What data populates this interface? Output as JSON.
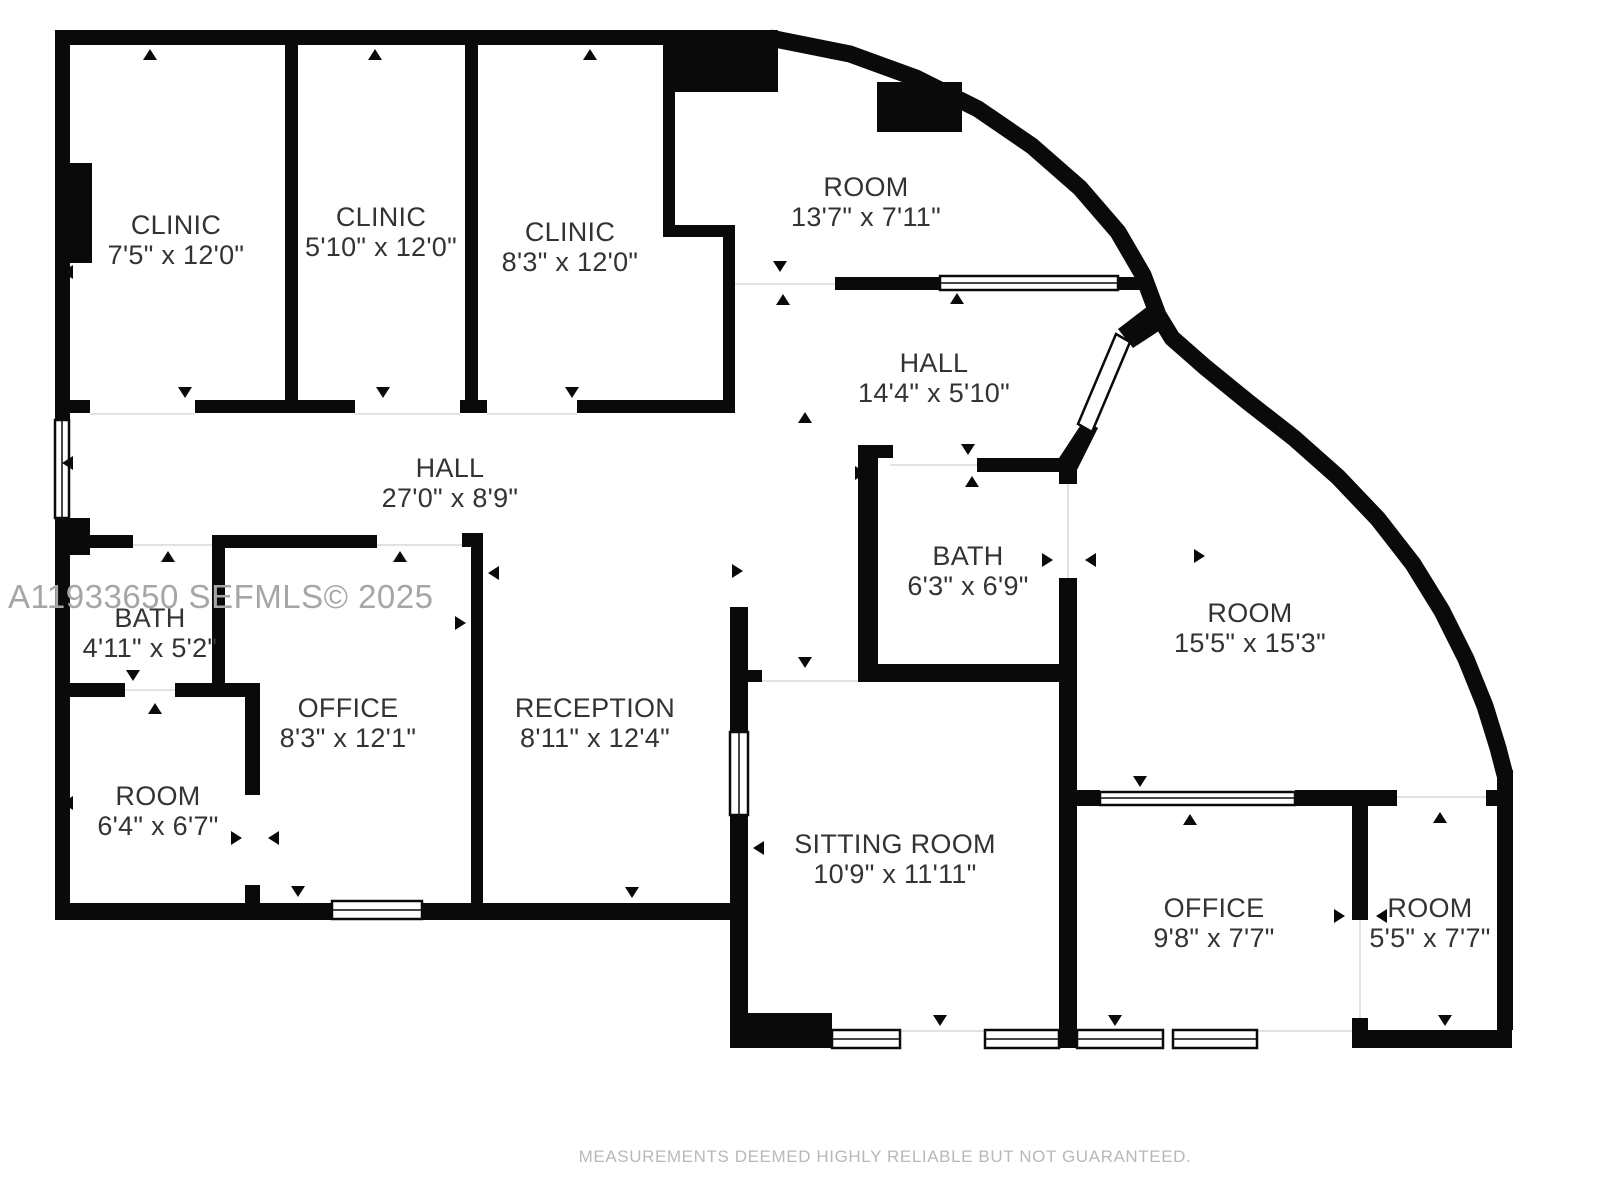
{
  "floor_plan": {
    "type": "real-estate-floor-plan",
    "rooms": [
      {
        "id": "clinic-1",
        "name": "CLINIC",
        "dims": "7'5\" x 12'0\""
      },
      {
        "id": "clinic-2",
        "name": "CLINIC",
        "dims": "5'10\" x 12'0\""
      },
      {
        "id": "clinic-3",
        "name": "CLINIC",
        "dims": "8'3\" x 12'0\""
      },
      {
        "id": "room-top",
        "name": "ROOM",
        "dims": "13'7\" x 7'11\""
      },
      {
        "id": "hall-upper",
        "name": "HALL",
        "dims": "14'4\" x 5'10\""
      },
      {
        "id": "hall-main",
        "name": "HALL",
        "dims": "27'0\" x 8'9\""
      },
      {
        "id": "bath-small",
        "name": "BATH",
        "dims": "4'11\" x 5'2\""
      },
      {
        "id": "office-left",
        "name": "OFFICE",
        "dims": "8'3\" x 12'1\""
      },
      {
        "id": "reception",
        "name": "RECEPTION",
        "dims": "8'11\" x 12'4\""
      },
      {
        "id": "room-small",
        "name": "ROOM",
        "dims": "6'4\" x 6'7\""
      },
      {
        "id": "bath-right",
        "name": "BATH",
        "dims": "6'3\" x 6'9\""
      },
      {
        "id": "room-large",
        "name": "ROOM",
        "dims": "15'5\" x 15'3\""
      },
      {
        "id": "sitting-room",
        "name": "SITTING ROOM",
        "dims": "10'9\" x 11'11\""
      },
      {
        "id": "office-right",
        "name": "OFFICE",
        "dims": "9'8\" x 7'7\""
      },
      {
        "id": "room-bottom",
        "name": "ROOM",
        "dims": "5'5\" x 7'7\""
      }
    ],
    "watermark": "A11933650  SEFMLS© 2025",
    "disclaimer": "MEASUREMENTS DEEMED HIGHLY RELIABLE BUT NOT GUARANTEED.",
    "colors": {
      "wall": "#0a0a0a",
      "label": "#333333",
      "watermark": "#a6a6a6",
      "disclaimer": "#b8b8b8",
      "background": "#ffffff"
    }
  }
}
